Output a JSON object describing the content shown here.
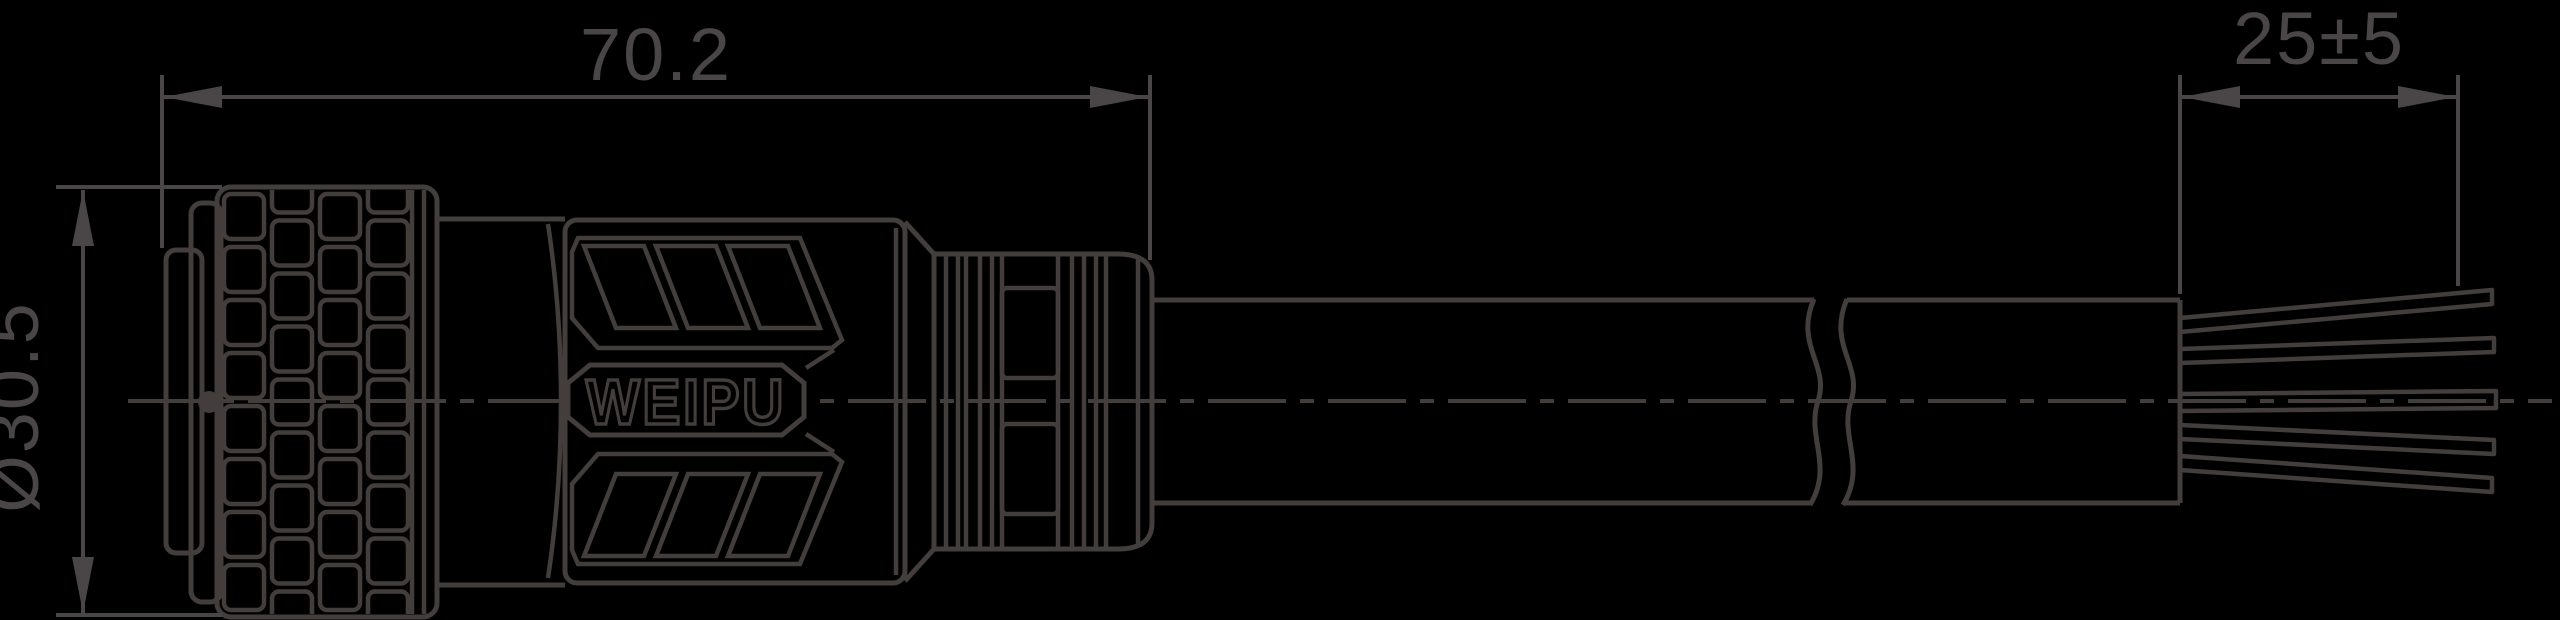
{
  "drawing": {
    "title": "WEIPU circular connector with cable - dimensional drawing",
    "background_color": "#000000",
    "line_color": "#433d3c",
    "text_color": "#4a4546",
    "logo_text": "WEIPU",
    "dimensions": {
      "overall_length": "70.2",
      "diameter": "Ø30.5",
      "wire_strip_length": "25±5"
    }
  }
}
